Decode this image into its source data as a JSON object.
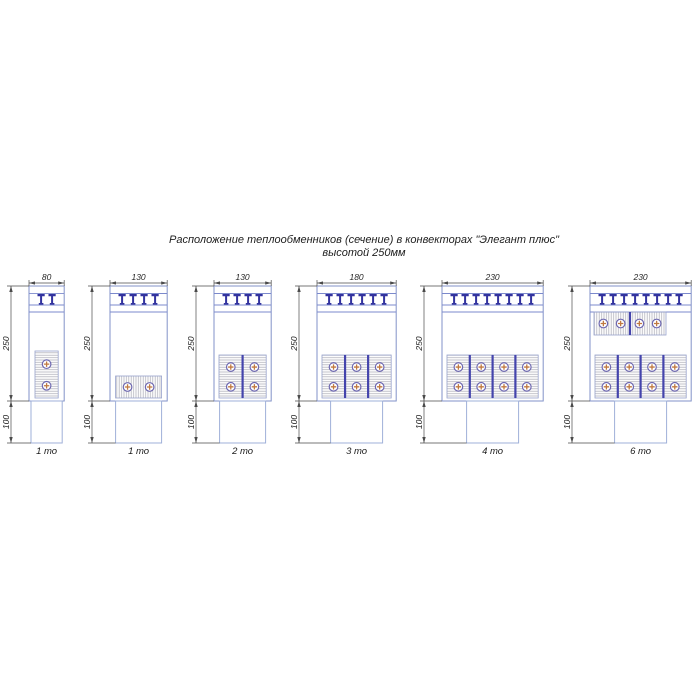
{
  "title": {
    "line1": "Расположение теплообменников (сечение) в конвекторах \"Элегант плюс\"",
    "line2": "высотой 250мм"
  },
  "colors": {
    "outline": "#8292c8",
    "outline_light": "#9fb0d8",
    "grille": "#32329e",
    "grille_line": "#7b89cc",
    "hatch": "#b2b2bb",
    "block_border": "#97a2cc",
    "divider": "#4444ac",
    "circle_ring": "#6e68b0",
    "circle_cross": "#c07940",
    "dim_line": "#4a4a4a",
    "dim_text": "#262626",
    "caption_text": "#1a1a1a",
    "background": "#ffffff"
  },
  "diagrams": [
    {
      "id": "conv-80-1to",
      "width_label": "80",
      "width_mm": 80,
      "height_label": "250",
      "base_label": "100",
      "teeth": 2,
      "caption": "1 то",
      "rows": [
        {
          "kind": "vertical",
          "count": 1,
          "circles_per_block": 2,
          "pos": "bottom"
        }
      ]
    },
    {
      "id": "conv-130-1to",
      "width_label": "130",
      "width_mm": 130,
      "height_label": "250",
      "base_label": "100",
      "teeth": 4,
      "caption": "1 то",
      "rows": [
        {
          "kind": "horizontal",
          "count": 1,
          "circles_per_block": 2,
          "pos": "bottom"
        }
      ]
    },
    {
      "id": "conv-130-2to",
      "width_label": "130",
      "width_mm": 130,
      "height_label": "250",
      "base_label": "100",
      "teeth": 4,
      "caption": "2 то",
      "rows": [
        {
          "kind": "vertical",
          "count": 2,
          "circles_per_block": 2,
          "pos": "bottom"
        }
      ]
    },
    {
      "id": "conv-180-3to",
      "width_label": "180",
      "width_mm": 180,
      "height_label": "250",
      "base_label": "100",
      "teeth": 6,
      "caption": "3 то",
      "rows": [
        {
          "kind": "vertical",
          "count": 3,
          "circles_per_block": 2,
          "pos": "bottom"
        }
      ]
    },
    {
      "id": "conv-230-4to",
      "width_label": "230",
      "width_mm": 230,
      "height_label": "250",
      "base_label": "100",
      "teeth": 8,
      "caption": "4 то",
      "rows": [
        {
          "kind": "vertical",
          "count": 4,
          "circles_per_block": 2,
          "pos": "bottom"
        }
      ]
    },
    {
      "id": "conv-230-6to",
      "width_label": "230",
      "width_mm": 230,
      "height_label": "250",
      "base_label": "100",
      "teeth": 8,
      "caption": "6 то",
      "rows": [
        {
          "kind": "horizontal",
          "count": 2,
          "circles_per_block": 2,
          "pos": "top"
        },
        {
          "kind": "vertical",
          "count": 4,
          "circles_per_block": 2,
          "pos": "bottom"
        }
      ]
    }
  ]
}
